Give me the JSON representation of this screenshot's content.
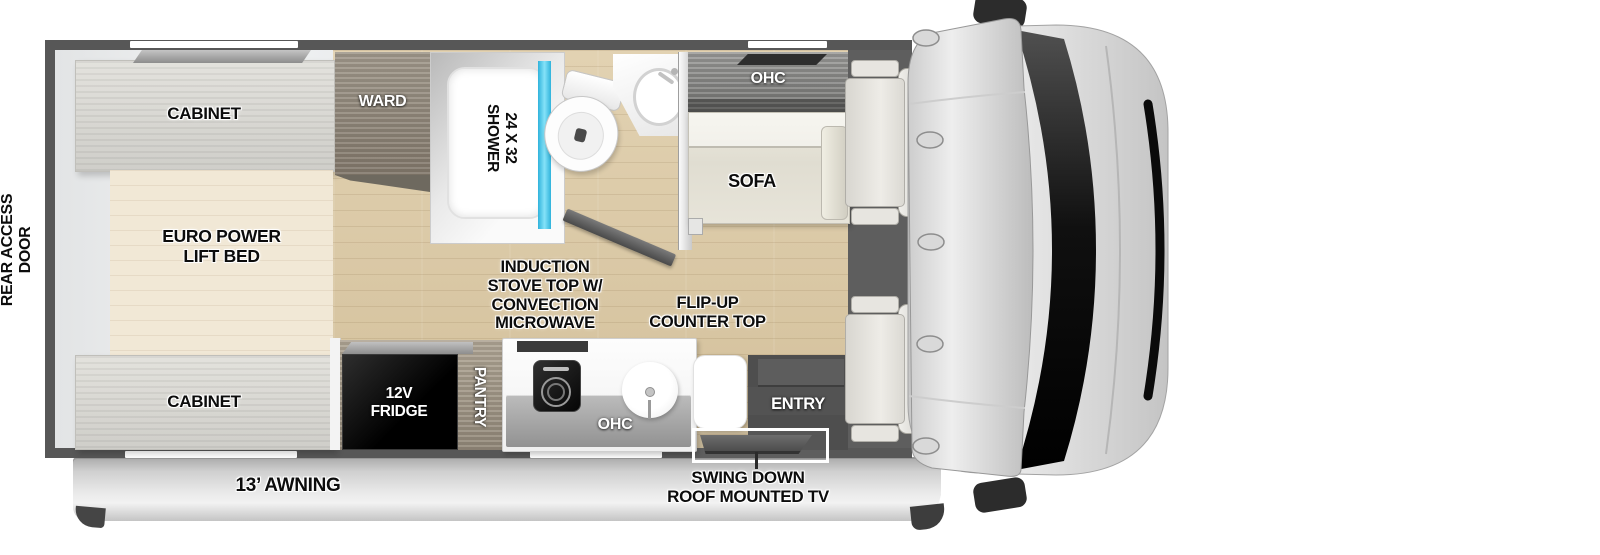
{
  "labels": {
    "rear_access_door": "REAR ACCESS\nDOOR",
    "cabinet_top": "CABINET",
    "bed": "EURO POWER\nLIFT BED",
    "cabinet_bottom": "CABINET",
    "ward": "WARD",
    "shower": "24 X 32\nSHOWER",
    "ohc_living": "OHC",
    "sofa": "SOFA",
    "fridge": "12V\nFRIDGE",
    "pantry": "PANTRY",
    "stove_note": "INDUCTION\nSTOVE TOP W/\nCONVECTION\nMICROWAVE",
    "counter_note": "FLIP-UP\nCOUNTER TOP",
    "ohc_kitchen": "OHC",
    "entry": "ENTRY",
    "awning": "13’ AWNING",
    "tv_note": "SWING DOWN\nROOF MOUNTED TV"
  },
  "colors": {
    "wall": "#575757",
    "floor_wood": "#d9c8a6",
    "bedroom_floor": "#ecedee",
    "bed_wood": "#f1e8d6",
    "cabinet_wood": "#dad9d4",
    "ward_wood": "#948b7e",
    "ohc_wood": "#8f8f8d",
    "sofa": "#e4e1d6",
    "shower_glass": "#45c6ea",
    "fridge": "#0a0a0a",
    "entry": "#4e4e4e",
    "awning": "#d9d9d9",
    "cab_body": "#d6d6d6",
    "windshield": "#0d0d0d"
  }
}
